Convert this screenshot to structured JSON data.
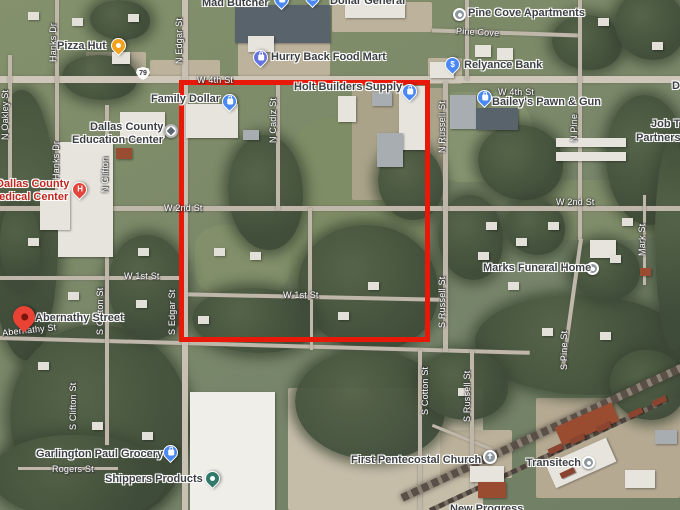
{
  "route_shield": "79",
  "colors": {
    "overlay_rectangle": "#e81909",
    "pin_blue": "#4a89f3",
    "pin_amber": "#f4a11c",
    "pin_fuel_indigo": "#6273e0",
    "pin_gray": "#8d979e",
    "pin_teal": "#317a6b",
    "pin_hospital_red": "#e2453c",
    "marker_red": "#ea4335",
    "poi_text": "#3c4043",
    "poi_text_red": "#c0271e",
    "street_text": "#ffffff"
  },
  "pois": {
    "mad_butcher": "Mad Butcher",
    "dollar_general": "Dollar General",
    "pine_cove_apartments": "Pine Cove Apartments",
    "pizza_hut": "Pizza Hut",
    "hurry_back_food_mart": "Hurry Back Food Mart",
    "relyance_bank": "Relyance Bank",
    "holt_builders_supply": "Holt Builders Supply",
    "family_dollar": "Family Dollar",
    "baileys_pawn_gun": "Bailey's Pawn & Gun",
    "job_line1": "Job T",
    "job_line2": "Partnersh",
    "d_partial": "D",
    "edu_line1": "Dallas County",
    "edu_line2": "Education Center",
    "med_line1": "Dallas County",
    "med_line2": "Medical Center",
    "marks_funeral_home": "Marks Funeral Home",
    "abernathy_street": "Abernathy Street",
    "garlington_paul_grocery": "Garlington Paul Grocery",
    "shippers_products": "Shippers Products",
    "first_pentecostal_church": "First Pentecostal Church",
    "transitech": "Transitech",
    "new_progress_partial": "New Progress"
  },
  "streets": {
    "n_oakley": "N Oakley St",
    "hanks_dr": "Hanks Dr",
    "n_edgar": "N Edgar St",
    "s_edgar": "S Edgar St",
    "w_4th": "W 4th St",
    "pine_cove": "Pine Cove",
    "n_cadiz": "N Cadiz St",
    "n_russell": "N Russell St",
    "s_russell": "S Russell St",
    "n_clifton": "N Clifton",
    "s_clifton": "S Clifton St",
    "w_2nd": "W 2nd St",
    "w_1st": "W 1st St",
    "abernathy": "Abernathy St",
    "mark": "Mark St",
    "n_pine": "N Pine",
    "s_pine": "S Pine St",
    "s_cotton": "S Cotton St",
    "rogers": "Rogers St"
  }
}
